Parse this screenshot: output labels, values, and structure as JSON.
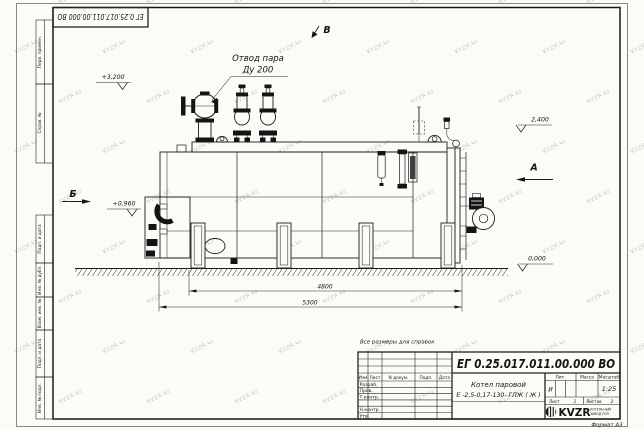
{
  "document": {
    "doc_number": "ЕГ 0.25.017.011.00.000  ВО",
    "format_label": "Формат А3",
    "reference_note": "Все размеры для справок",
    "watermark": "KVZR.kz"
  },
  "drawing": {
    "callout": {
      "line1": "Отвод пара",
      "line2": "Ду 200"
    },
    "views": {
      "a": "А",
      "b": "Б",
      "v": "В"
    },
    "elevations": {
      "top": "+3,200",
      "burner": "+0,960",
      "deck": "2,400",
      "ground": "0,000"
    },
    "dimensions": {
      "support_span": "4800",
      "overall_length": "5300"
    }
  },
  "title_block": {
    "doc_number": "ЕГ 0.25.017.011.00.000  ВО",
    "product_line1": "Котел паровой",
    "product_line2": "Е -2,5-0,17-130- ГЛЖ ( Ж )",
    "columns": {
      "izm": "Изм",
      "list": "Лист",
      "n_dokum": "N докум.",
      "podp": "Подп.",
      "data": "Дата"
    },
    "rows": {
      "razrab": "Разраб.",
      "prov": "Пров.",
      "t_kontr": "Т.контр.",
      "n_kontr": "Н.контр.",
      "utv": "Утв."
    },
    "lit_header": "Лит.",
    "massa_header": "Масса",
    "masshtab_header": "Масштаб",
    "lit_value": "И",
    "scale_value": "1:25",
    "list_label": "Лист",
    "list_value": "1",
    "listov_label": "Листов",
    "listov_value": "2",
    "logo_text": "KVZR",
    "logo_sub1": "КОТЕЛЬНЫЙ",
    "logo_sub2": "ЗАВОД РЭП"
  },
  "margin_stamps": {
    "perv_primen": "Перв. примен.",
    "sprav_no": "Справ. №",
    "podp_data_1": "Подп. и дата",
    "inv_dubl": "Инв. № дубл.",
    "vzam_inv": "Взам. инв. №",
    "podp_data_2": "Подп. и дата",
    "inv_podl": "Инв. № подл."
  }
}
